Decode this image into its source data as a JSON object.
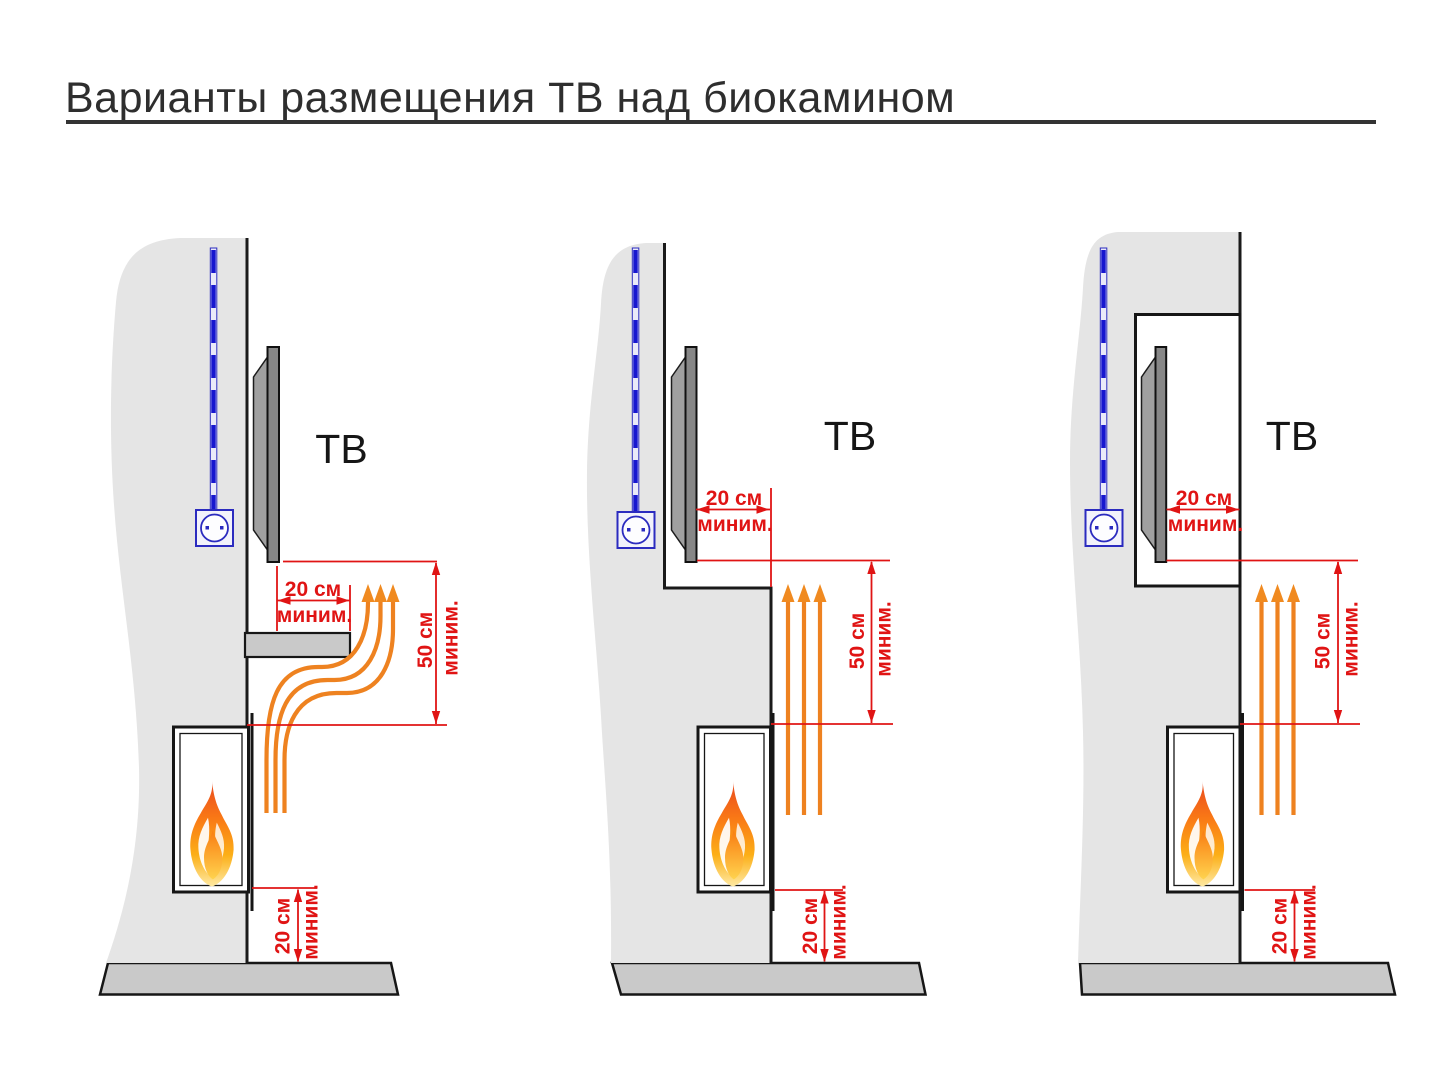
{
  "title": "Варианты размещения ТВ над биокамином",
  "colors": {
    "dimension_red": "#e01414",
    "heat_orange": "#ee8220",
    "cable_blue": "#2424c8",
    "wall_gray": "#e5e5e5",
    "floor_gray": "#c9c9c9"
  },
  "diagrams": [
    {
      "tv_label": "ТВ",
      "front_gap": {
        "value": "20 см",
        "qualifier": "миним."
      },
      "above_gap": {
        "value": "50 см",
        "qualifier": "миним."
      },
      "floor_gap": {
        "value": "20 см",
        "qualifier": "миним."
      }
    },
    {
      "tv_label": "ТВ",
      "front_gap": {
        "value": "20 см",
        "qualifier": "миним."
      },
      "above_gap": {
        "value": "50 см",
        "qualifier": "миним."
      },
      "floor_gap": {
        "value": "20 см",
        "qualifier": "миним."
      }
    },
    {
      "tv_label": "ТВ",
      "front_gap": {
        "value": "20 см",
        "qualifier": "миним."
      },
      "above_gap": {
        "value": "50 см",
        "qualifier": "миним."
      },
      "floor_gap": {
        "value": "20 см",
        "qualifier": "миним."
      }
    }
  ]
}
